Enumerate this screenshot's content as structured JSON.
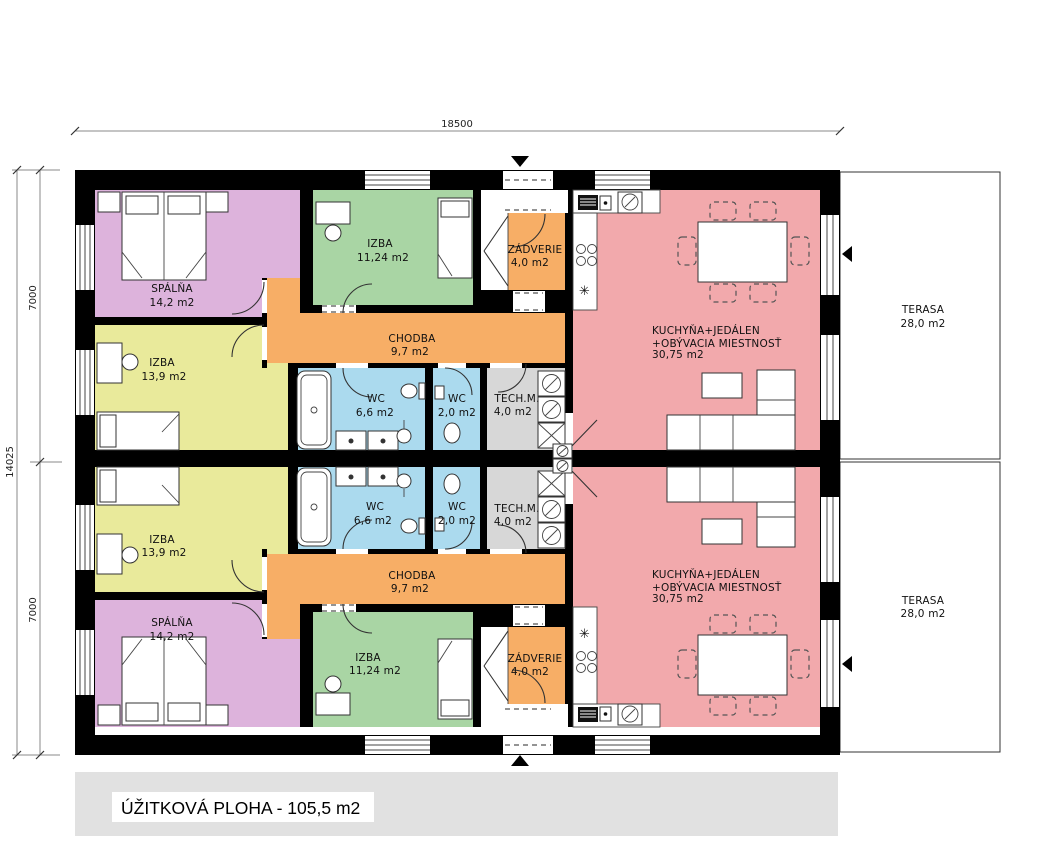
{
  "colors": {
    "spalna": "#ddb3dc",
    "izba_small": "#a9d5a4",
    "izba_large": "#e9ea9b",
    "chodba": "#f7ae66",
    "zadverie": "#f7ae66",
    "wc": "#abdaee",
    "tech": "#d7d7d7",
    "kitchen": "#f2a9ac",
    "terrace": "#ffffff",
    "footer_bg": "#e1e1e1",
    "wall": "#000000"
  },
  "rooms": {
    "spalna": {
      "name": "SPÁLŇA",
      "area": "14,2 m2"
    },
    "izba_small": {
      "name": "IZBA",
      "area": "11,24 m2"
    },
    "izba_large": {
      "name": "IZBA",
      "area": "13,9 m2"
    },
    "chodba": {
      "name": "CHODBA",
      "area": "9,7 m2"
    },
    "wc_large": {
      "name": "WC",
      "area": "6,6 m2"
    },
    "wc_small": {
      "name": "WC",
      "area": "2,0 m2"
    },
    "tech": {
      "name": "TECH.M.",
      "area": "4,0 m2"
    },
    "zadverie": {
      "name": "ZÁDVERIE",
      "area": "4,0 m2"
    },
    "kuchyna": {
      "line1": "KUCHYŇA+JEDÁLEN",
      "line2": "+OBÝVACIA MIESTNOSŤ",
      "area": "30,75 m2"
    },
    "terasa": {
      "name": "TERASA",
      "area": "28,0 m2"
    }
  },
  "dimensions": {
    "total_width": "18500",
    "total_height": "14025",
    "unit_height_top": "7000",
    "unit_height_bottom": "7000"
  },
  "footer": {
    "label": "ÚŽITKOVÁ PLOHA - 105,5 m2"
  },
  "icons": {
    "snowflake": "✳"
  }
}
